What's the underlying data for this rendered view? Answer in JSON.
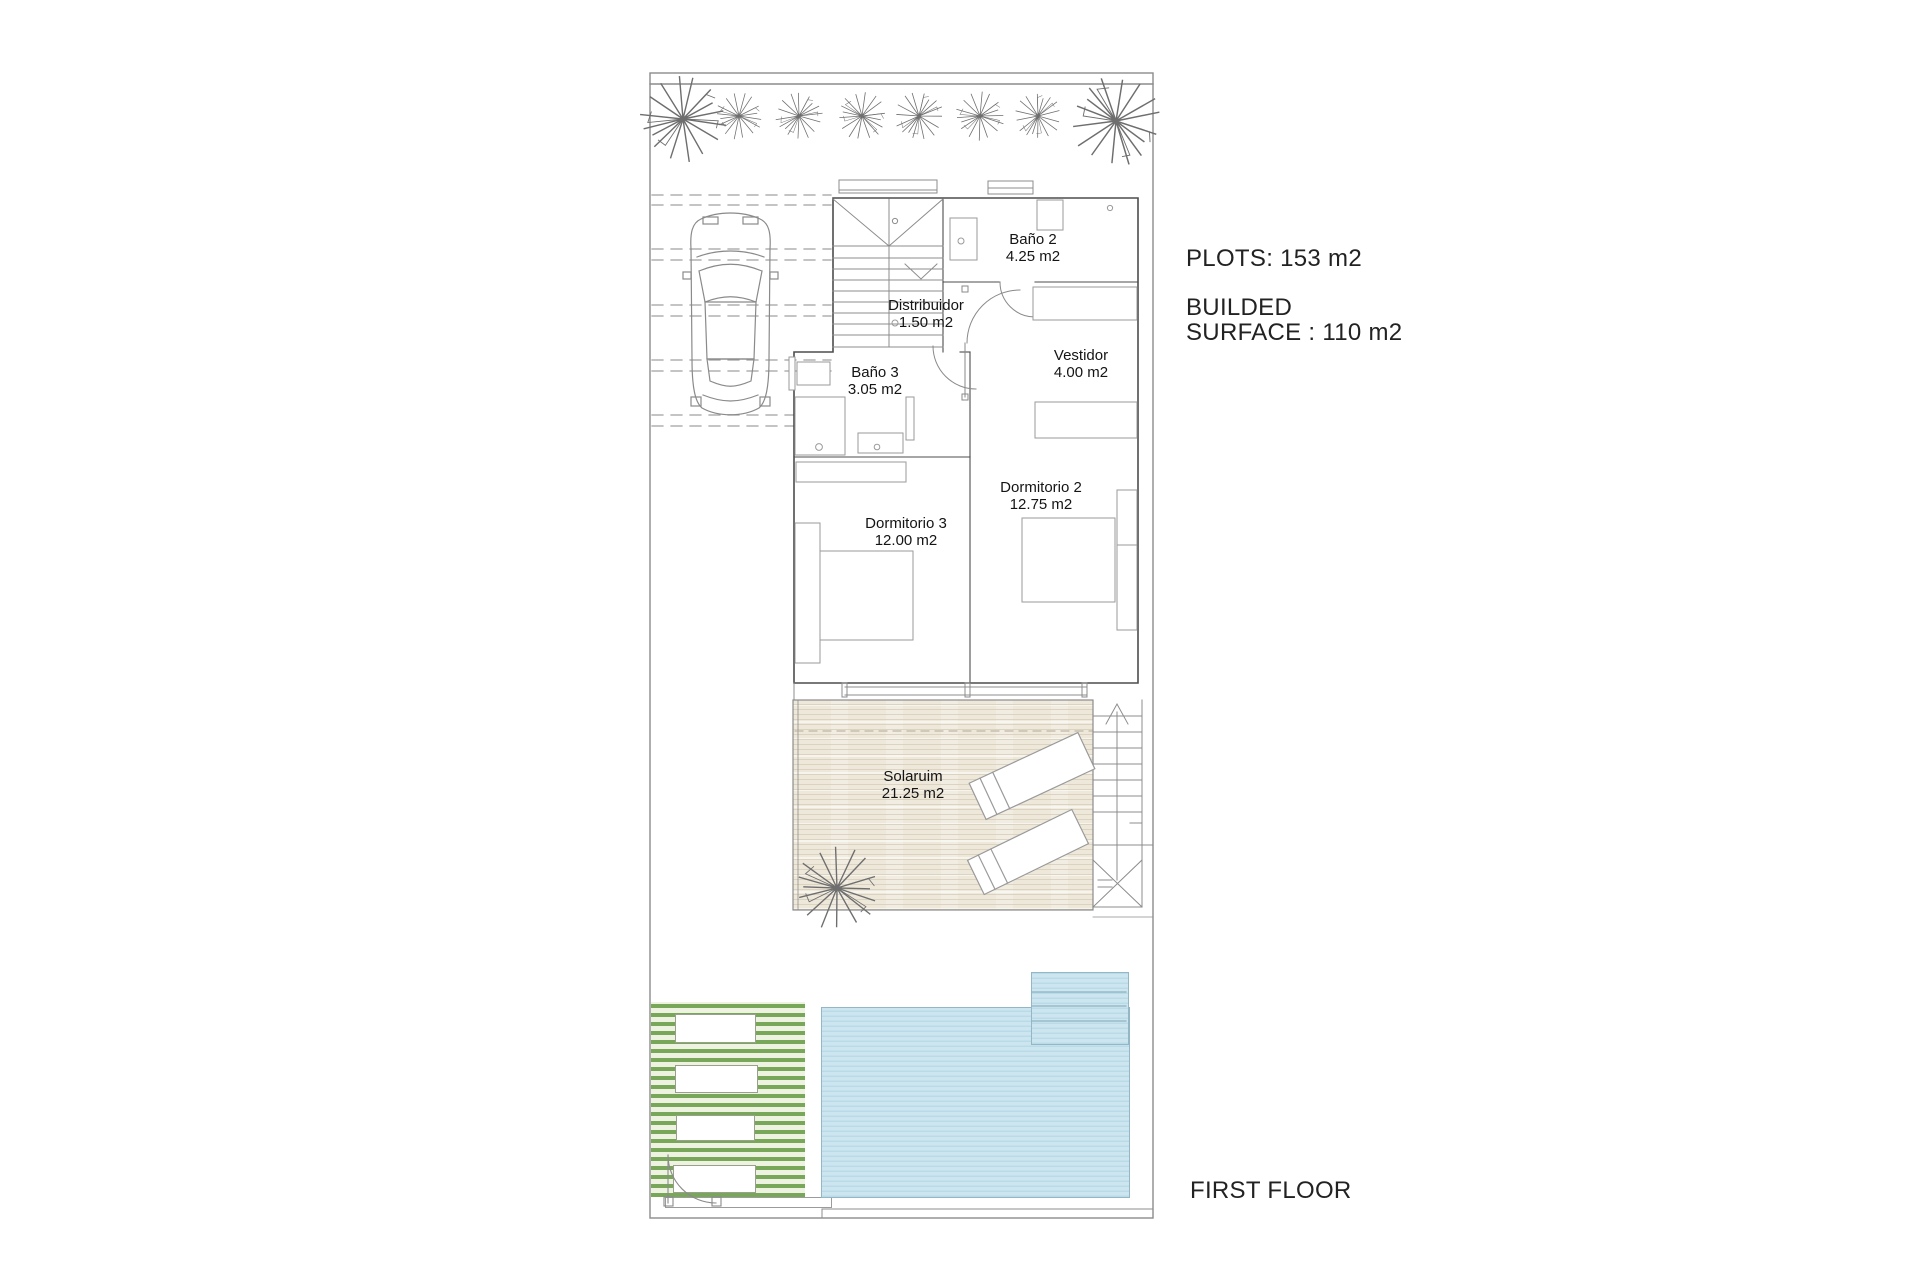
{
  "annotations": {
    "plots": "PLOTS: 153 m2",
    "builded_line1": "BUILDED",
    "builded_line2": "SURFACE : 110 m2",
    "floor": "FIRST FLOOR"
  },
  "rooms": [
    {
      "name": "Baño 2",
      "area": "4.25 m2"
    },
    {
      "name": "Distribuidor",
      "area": "1.50 m2"
    },
    {
      "name": "Baño 3",
      "area": "3.05 m2"
    },
    {
      "name": "Vestidor",
      "area": "4.00 m2"
    },
    {
      "name": "Dormitorio 2",
      "area": "12.75 m2"
    },
    {
      "name": "Dormitorio 3",
      "area": "12.00 m2"
    },
    {
      "name": "Solaruim",
      "area": "21.25 m2"
    }
  ],
  "colors": {
    "pool_water": "#cde5ef",
    "pool_stripe": "#b9dbe8",
    "pool_border": "#93b7c6",
    "deck_green_stripe": "#79a75a",
    "deck_green_bg": "#eef3e1",
    "wood_deck": "#f2ede2",
    "wood_line": "#d9d0bd",
    "wall_line": "#4d4d4d",
    "plot_line": "#8c8c8c",
    "text": "#1f1f1f"
  },
  "icons": {
    "plant": "starburst palm plan-view lines",
    "car": "car top-view outline",
    "stairs_arrow": "up direction arrow"
  }
}
